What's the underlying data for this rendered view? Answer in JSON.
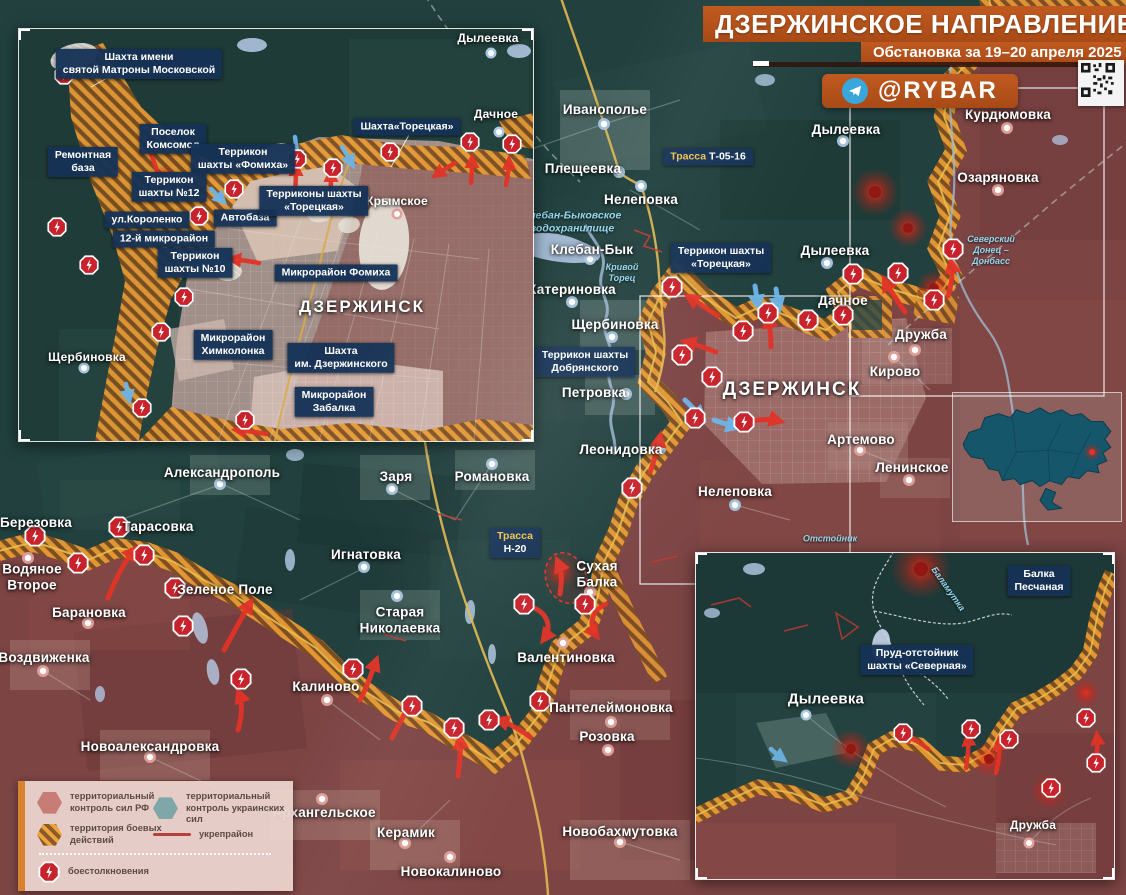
{
  "header": {
    "title": "ДЗЕРЖИНСКОЕ НАПРАВЛЕНИЕ",
    "subtitle": "Обстановка за 19–20 апреля 2025 г.",
    "telegram": "@RYBAR"
  },
  "legend": {
    "rf": "территориальный контроль сил РФ",
    "ua": "территориальный контроль украинских сил",
    "combat": "территория боевых действий",
    "fort": "укрепрайон",
    "clash": "боестолкновения"
  },
  "colors": {
    "rf_territory": "#7d4444",
    "ua_territory": "#21403e",
    "combat_stripe": "#e89b33",
    "banner_orange": "#b5531d",
    "chip_navy": "#153256",
    "clash_red": "#c8232c",
    "road_yellow": "#e2b951",
    "water_text": "#92d7ee"
  },
  "main": {
    "towns": {
      "ivanopolye": "Иванополье",
      "pleshcheevka": "Плещеевка",
      "nelepovka": "Нелеповка",
      "kleban_byk": "Клебан-Бык",
      "katerinovka": "Катериновка",
      "shcherbinovka": "Щербиновка",
      "petrovka": "Петровка",
      "leonidovka": "Леонидовка",
      "nelepovka2": "Нелеповка",
      "kurdyumovka": "Курдюмовка",
      "ozaryanovka": "Озаряновка",
      "dyleevka_n": "Дылеевка",
      "dyleevka_w": "Дылеевка",
      "dachnoe": "Дачное",
      "druzhba": "Дружба",
      "kirovo": "Кирово",
      "artemovo": "Артемово",
      "leninskoe": "Ленинское",
      "dzerzhinsk": "ДЗЕРЖИНСК",
      "aleksandropol": "Александрополь",
      "berezovka": "Березовка",
      "tarasovka": "Тарасовка",
      "vodyanoe": "Водяное\nВторое",
      "zelenoe_pole": "Зеленое Поле",
      "baranovka": "Барановка",
      "vozdvizhenka": "Воздвиженка",
      "zarya": "Заря",
      "romanovka": "Романовка",
      "ignatovka": "Игнатовка",
      "st_nikolaevka": "Старая\nНиколаевка",
      "sukhaya_balka": "Сухая\nБалка",
      "valentinovka": "Валентиновка",
      "kalinovo": "Калиново",
      "panteleymonovka": "Пантелеймоновка",
      "rozovka": "Розовка",
      "novoaleksandrovka": "Новоалександровка",
      "arkhangelskoe": "Архангельское",
      "keramik": "Керамик",
      "novobakhmutovka": "Новобахмутовка",
      "novokalinovo": "Новокалиново"
    },
    "chips": {
      "terrikon_toretskaya": "Террикон шахты\n«Торецкая»",
      "terrikon_dobryanskogo": "Террикон шахты\nДобрянского",
      "trassa_prefix": "Трасса",
      "trassa_t_num": "Т-05-16",
      "trassa_n_num": "Н-20"
    },
    "waters": {
      "kleban_res": "Клебан-Быковское\nводохранилище",
      "krivoy_torets": "Кривой\nТорец",
      "canal": "Северский\nДонец –\nДонбасс",
      "otstoynik": "Отстойник"
    }
  },
  "inset_city": {
    "towns": {
      "dyleevka": "Дылеевка",
      "dachnoe": "Дачное",
      "krymskoe": "Крымское",
      "shcherbinovka": "Щербиновка",
      "dzerzhinsk": "ДЗЕРЖИНСК"
    },
    "chips": {
      "matrona": "Шахта имени\nсвятой Матроны Московской",
      "komsomol": "Поселок\nКомсомол",
      "rembaza": "Ремонтная\nбаза",
      "fomikha": "Террикон\nшахты «Фомиха»",
      "t12": "Террикон\nшахты №12",
      "korolenko": "ул.Короленко",
      "avtobaza": "Автобаза",
      "mkr12": "12-й микрорайон",
      "t10": "Террикон\nшахты №10",
      "toretskie": "Терриконы шахты\n«Торецкая»",
      "shakhta_toretskaya": "Шахта«Торецкая»",
      "mkr_fomikha": "Микрорайон Фомиха",
      "khimkolonka": "Микрорайон\nХимколонка",
      "dzerzh_mine": "Шахта\nим. Дзержинского",
      "zabalka": "Микрорайон\nЗабалка"
    }
  },
  "inset_se": {
    "towns": {
      "dyleevka": "Дылеевка",
      "druzhba": "Дружба"
    },
    "chips": {
      "balka_peschanaya": "Балка\nПесчаная",
      "prud": "Пруд-отстойник\nшахты «Северная»"
    },
    "waters": {
      "balamutka": "Баламутка"
    }
  }
}
